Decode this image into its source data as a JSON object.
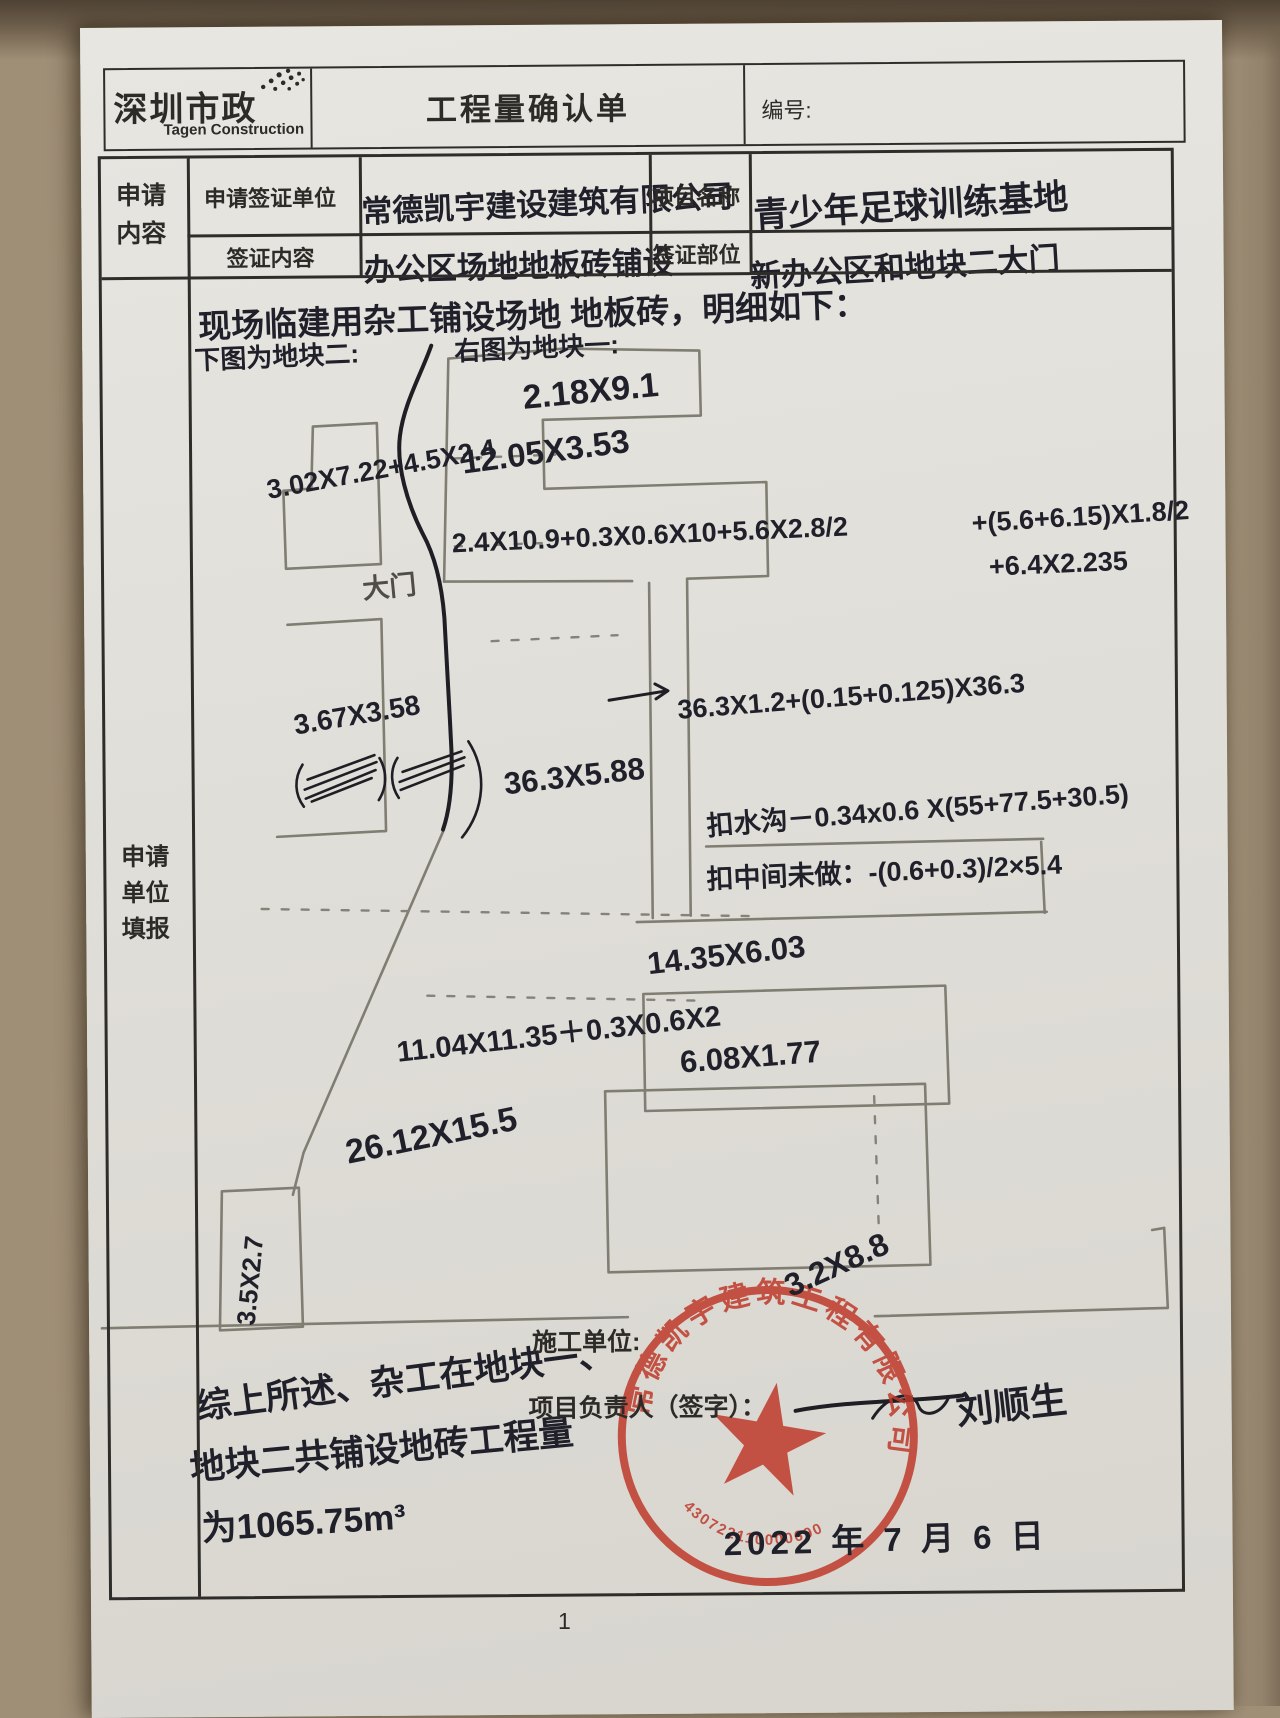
{
  "header": {
    "logo_title": "深圳市政",
    "logo_subtitle": "Tagen Construction",
    "form_title": "工程量确认单",
    "serial_label": "编号:"
  },
  "form": {
    "left_header": "申请内容",
    "row1_label": "申请签证单位",
    "row1_value": "常德凯宇建设建筑有限公司",
    "row1_label2": "项目名称",
    "row1_value2": "青少年足球训练基地",
    "row2_label": "签证内容",
    "row2_value": "办公区场地地板砖铺设",
    "row2_label2": "签证部位",
    "row2_value2": "新办公区和地块二大门"
  },
  "main": {
    "left_header": "申请单位填报",
    "intro": "现场临建用杂工铺设场地 地板砖，明细如下：",
    "label_left_sketch": "下图为地块二:",
    "label_right_sketch": "右图为地块一:",
    "dims": [
      "2.18X9.1",
      "12.05X3.53",
      "3.02X7.22+4.5X2.4",
      "大门",
      "2.4X10.9+0.3X0.6X10+5.6X2.8/2",
      "+(5.6+6.15)X1.8/2",
      "+6.4X2.235",
      "3.67X3.58",
      "36.3X5.88",
      "36.3X1.2+(0.15+0.125)X36.3",
      "扣水沟－0.34x0.6 X(55+77.5+30.5)",
      "扣中间未做：-(0.6+0.3)/2×5.4",
      "14.35X6.03",
      "11.04X11.35＋0.3X0.6X2",
      "6.08X1.77",
      "26.12X15.5",
      "3.5X2.7",
      "3.2X8.8"
    ],
    "summary_line1": "综上所述、杂工在地块一、",
    "summary_line2": "地块二共铺设地砖工程量",
    "summary_line3": "为1065.75m³",
    "builder_label": "施工单位:",
    "manager_label": "项目负责人（签字）：",
    "signature": "刘顺生",
    "date": "2022 年 7 月 6 日"
  },
  "stamp": {
    "company": "常德凯宇建筑工程有限公司",
    "serial": "430722110000690",
    "color": "#bf3a2b"
  },
  "footer": {
    "page_number": "1"
  }
}
